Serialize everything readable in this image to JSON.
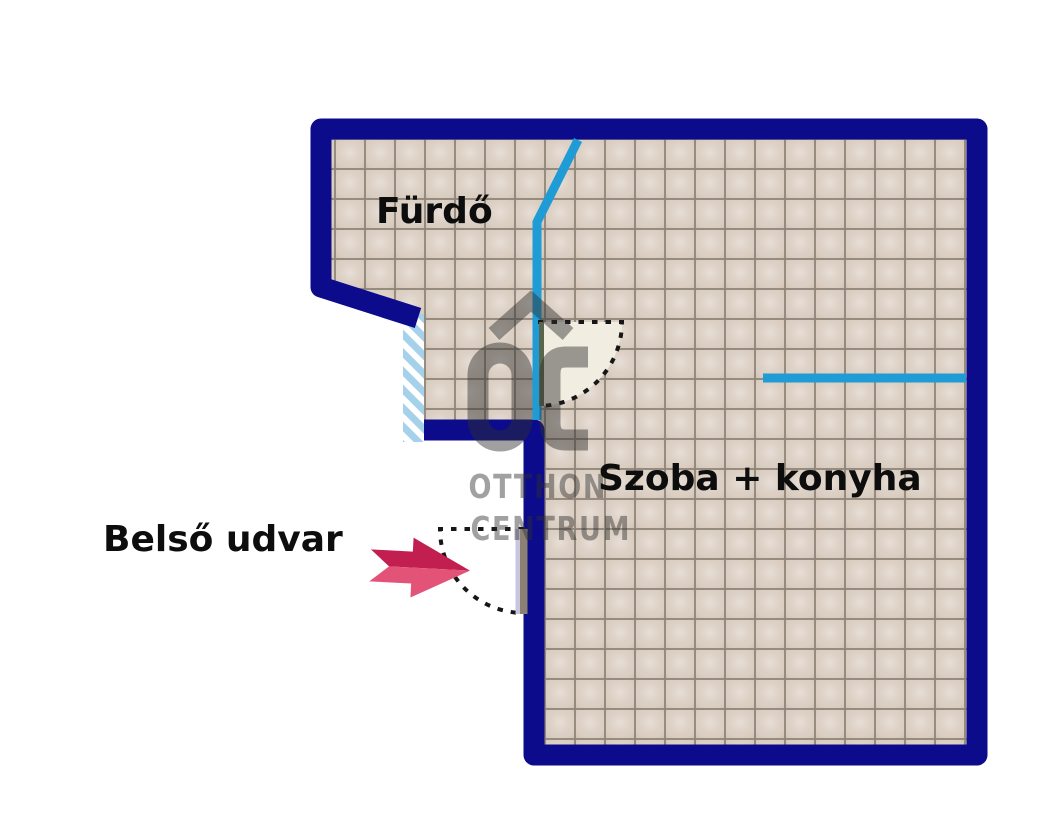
{
  "floorplan": {
    "rooms": [
      {
        "name": "Fürdő"
      },
      {
        "name": "Szoba + konyha"
      }
    ],
    "outside": {
      "name": "Belső udvar"
    },
    "watermark": {
      "line1": "OTTHON",
      "line2": "CENTRUM",
      "logo": "OC"
    },
    "colors": {
      "wall": "#0b0b8c",
      "partition": "#1f9cd6",
      "tile": "#d8cabd",
      "grout": "#8e8478",
      "hatch_base": "#a5d2ea",
      "door_swing_fill": "#f1ede1",
      "door_leaf_bathroom": "#5a664b",
      "door_leaf_entrance": "#8a8173",
      "door_leaf_entrance_edge": "#c9c5de",
      "arrow_dark": "#c21e50",
      "arrow_light": "#e25377",
      "watermark_gray": "#2f2f2f"
    }
  }
}
